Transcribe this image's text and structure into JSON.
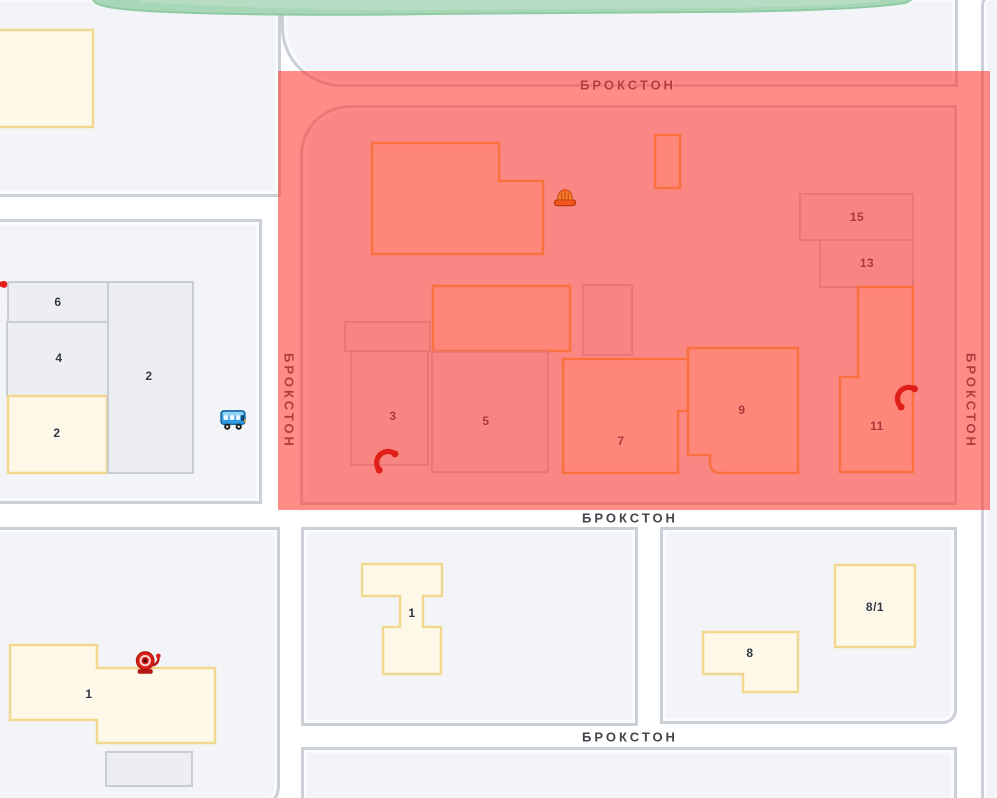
{
  "map": {
    "street_labels": {
      "top": "БРОКСТОН",
      "left": "БРОКСТОН",
      "right": "БРОКСТОН",
      "middle": "БРОКСТОН",
      "bottom": "БРОКСТОН"
    },
    "buildings": {
      "northwest_7": "7",
      "west_6": "6",
      "west_4": "4",
      "west_2_yellow": "2",
      "west_2_gray": "2",
      "zone_3": "3",
      "zone_5": "5",
      "zone_7": "7",
      "zone_9": "9",
      "zone_11": "11",
      "zone_13": "13",
      "zone_15": "15",
      "south_1_left": "1",
      "south_1_middle": "1",
      "south_8": "8",
      "south_8_1": "8/1"
    },
    "markers": {
      "phone_west": "phone-marker",
      "phone_zone_southwest": "phone-marker",
      "phone_zone_east": "phone-marker",
      "construction_helmet": "construction-marker",
      "alarm_bell": "alarm-marker",
      "bus_stop": "bus-stop-marker"
    },
    "colors": {
      "alert_zone": "rgba(255,56,48,0.58)",
      "road": "#ffffff",
      "block": "#f2f4f7",
      "block_border": "#cbd0d6",
      "building_yellow_fill": "#fdf8e8",
      "building_yellow_border": "#f2d78e",
      "building_gray_fill": "#eceef1",
      "building_gray_border": "#c9cdd3",
      "green_area": "#a8d7b8",
      "marker_red": "#e02018",
      "bus_blue": "#2f9be4",
      "helmet_orange": "#f3561d"
    }
  }
}
